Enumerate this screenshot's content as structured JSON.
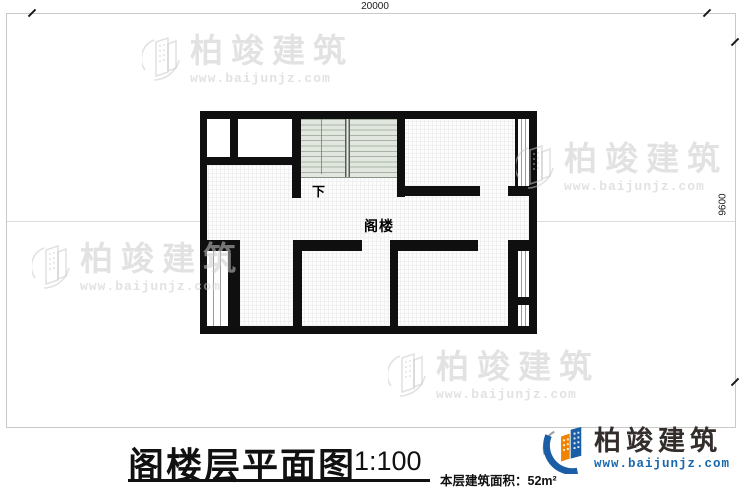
{
  "dimensions": {
    "top_label": "20000",
    "right_label": "9600"
  },
  "plan": {
    "attic_label": "阁楼",
    "stairs_down_label": "下"
  },
  "title_block": {
    "title": "阁楼层平面图",
    "scale": "1:100",
    "area_label": "本层建筑面积：",
    "area_value": "52m²"
  },
  "brand": {
    "company": "柏竣建筑",
    "website": "www.baijunjz.com"
  },
  "watermark": {
    "company": "柏竣建筑",
    "website": "www.baijunjz.com"
  },
  "colors": {
    "wall": "#0f0f0f",
    "stair_fill": "#e1e7df",
    "brand_blue": "#1b5ea6",
    "brand_orange": "#f08300",
    "url_blue": "#1767ad",
    "watermark_gray": "#cbcbcb"
  }
}
